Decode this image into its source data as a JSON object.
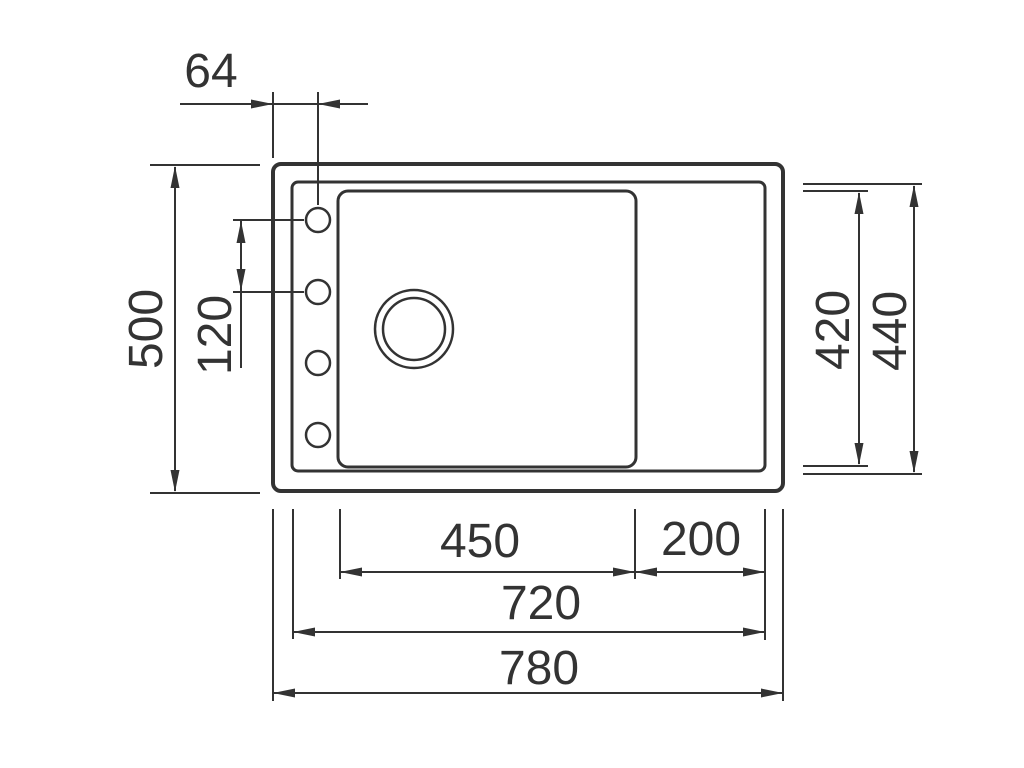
{
  "title": "Sink dimensional drawing (top view)",
  "colors": {
    "line": "#333333",
    "background": "#ffffff"
  },
  "dimensions": {
    "hole_offset_top": "64",
    "overall_height_left": "500",
    "hole_spacing_left": "120",
    "bowl_height_right": "420",
    "inner_height_right": "440",
    "bowl_width_bottom": "450",
    "drainer_width_bottom": "200",
    "inner_width_bottom": "720",
    "overall_width_bottom": "780"
  }
}
